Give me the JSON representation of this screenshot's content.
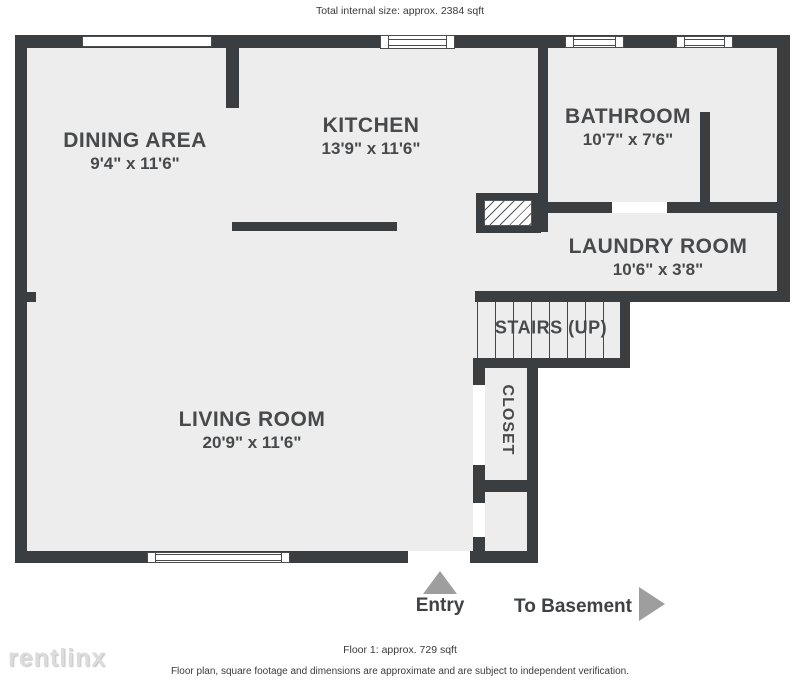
{
  "header": {
    "total_size": "Total internal size: approx. 2384 sqft"
  },
  "rooms": {
    "dining": {
      "name": "DINING AREA",
      "dims": "9'4\" x 11'6\""
    },
    "kitchen": {
      "name": "KITCHEN",
      "dims": "13'9\" x 11'6\""
    },
    "bathroom": {
      "name": "BATHROOM",
      "dims": "10'7\" x 7'6\""
    },
    "laundry": {
      "name": "LAUNDRY ROOM",
      "dims": "10'6\" x 3'8\""
    },
    "stairs": {
      "name": "STAIRS (UP)"
    },
    "closet": {
      "name": "CLOSET"
    },
    "living": {
      "name": "LIVING ROOM",
      "dims": "20'9\" x 11'6\""
    }
  },
  "annotations": {
    "entry": "Entry",
    "to_basement": "To Basement"
  },
  "footer": {
    "floor_size": "Floor 1: approx. 729 sqft",
    "disclaimer": "Floor plan, square footage and dimensions are approximate and are subject to independent verification."
  },
  "watermark": "rentlinx",
  "colors": {
    "wall": "#3b3e41",
    "floor": "#ededed",
    "arrow": "#9e9e9e",
    "label_text": "#47494b"
  }
}
